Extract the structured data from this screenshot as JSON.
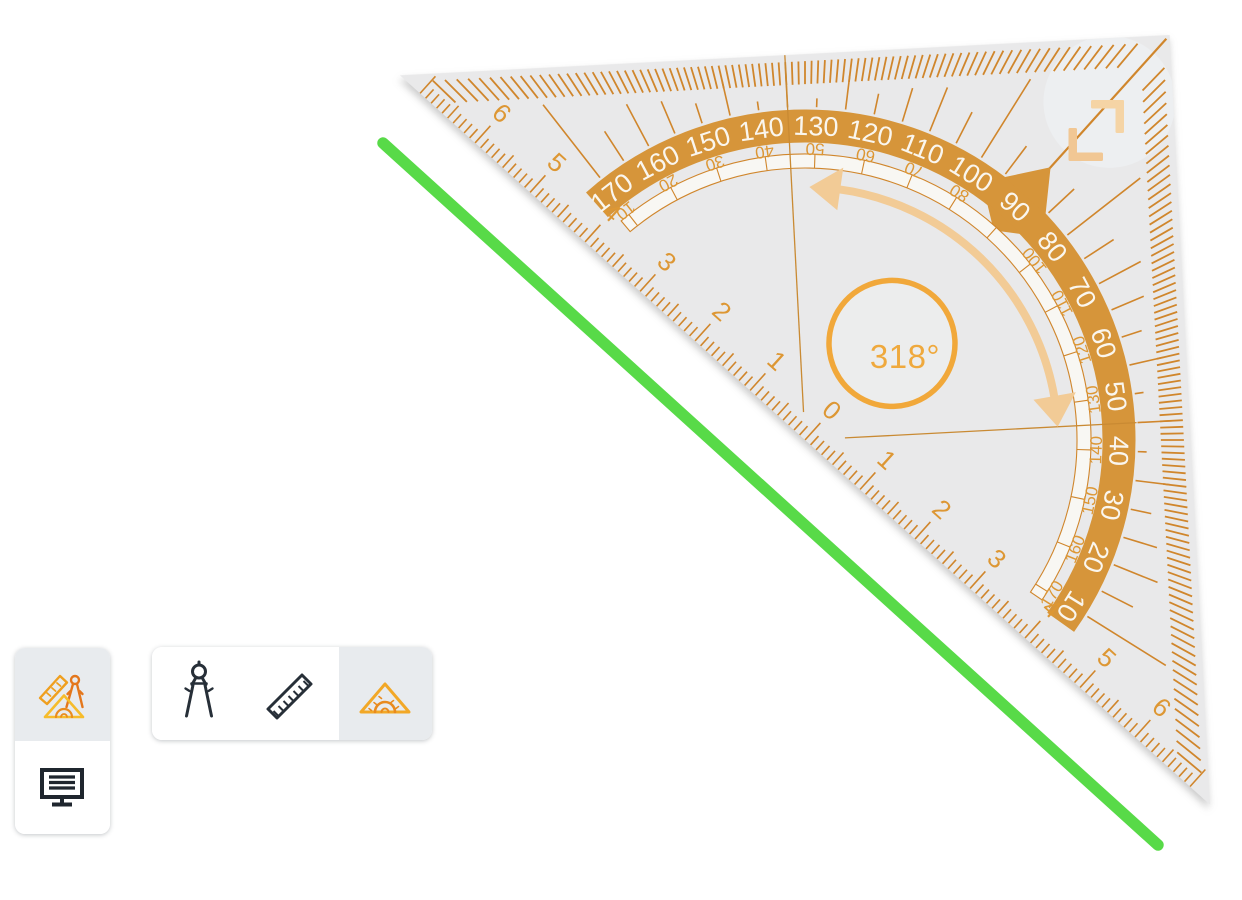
{
  "canvas": {
    "background": "#ffffff"
  },
  "drawn_line": {
    "color": "#58da48",
    "x1": 383,
    "y1": 143,
    "x2": 1158,
    "y2": 845,
    "width": 11.5
  },
  "geo_triangle": {
    "angle_label": "318°",
    "rotation_deg": 318,
    "outer_scale_deg": [
      10,
      20,
      30,
      40,
      50,
      60,
      70,
      80,
      90,
      100,
      110,
      120,
      130,
      140,
      150,
      160,
      170
    ],
    "inner_scale_deg": [
      10,
      20,
      30,
      40,
      50,
      60,
      70,
      80,
      100,
      110,
      120,
      130,
      140,
      150,
      160,
      170
    ],
    "ruler_numbers": [
      6,
      5,
      4,
      3,
      2,
      1,
      0,
      1,
      2,
      3,
      4,
      5,
      6
    ],
    "colors": {
      "body": "#e9e9ea",
      "band": "#d6953a",
      "band_text": "#faf6ee",
      "tick": "#d0862c",
      "label": "#dd9734",
      "reference_line": "#c98a33",
      "rotation_arrow": "#f2cb96",
      "handle_light": "#f5d4a5",
      "handle_dark": "#f1c794",
      "ring": "#f1a83a",
      "angle_text": "#efa93d",
      "channel_fill": "#f8f7f3"
    }
  },
  "toolbar": {
    "left": {
      "buttons": [
        {
          "icon": "geometry-tools",
          "selected": true
        },
        {
          "icon": "monitor-board",
          "selected": false
        }
      ]
    },
    "tools": {
      "buttons": [
        {
          "icon": "compass",
          "selected": false
        },
        {
          "icon": "ruler",
          "selected": false
        },
        {
          "icon": "set-square",
          "selected": true
        }
      ]
    }
  }
}
